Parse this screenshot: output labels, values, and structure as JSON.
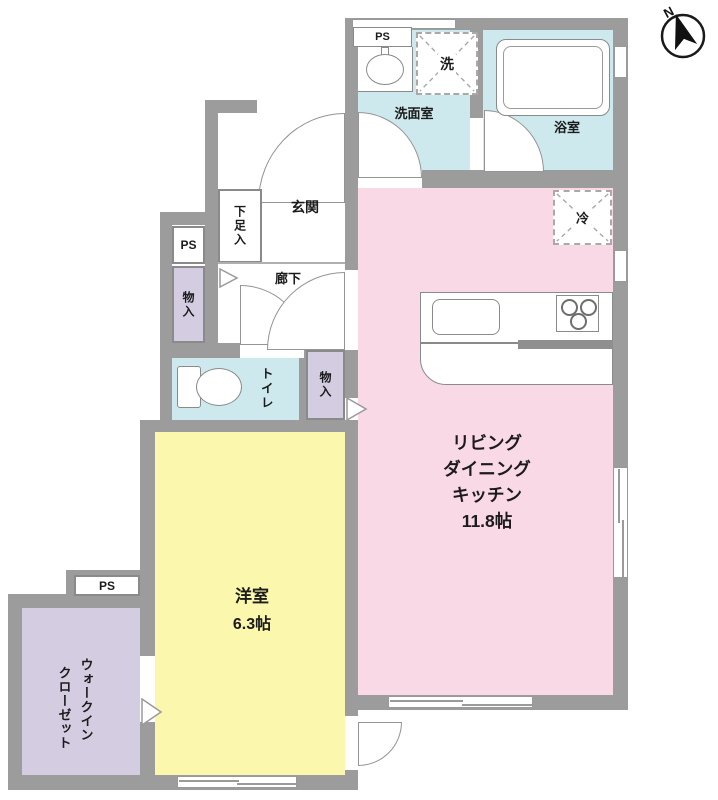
{
  "compass": {
    "north": "N"
  },
  "labels": {
    "ps": "PS"
  },
  "fixtures": {
    "washer": "洗",
    "fridge": "冷"
  },
  "rooms": {
    "ldk": {
      "lines": [
        "リビング",
        "ダイニング",
        "キッチン"
      ],
      "size": "11.8帖"
    },
    "bedroom": {
      "name": "洋室",
      "size": "6.3帖"
    },
    "washroom": {
      "name": "洗面室"
    },
    "bathroom": {
      "name": "浴室"
    },
    "toilet": {
      "name": "トイレ"
    },
    "hallway": {
      "name": "廊下"
    },
    "entrance": {
      "name": "玄関"
    },
    "shoe_cabinet": {
      "name": "下足入"
    },
    "storage_hall": {
      "name": "物入"
    },
    "storage_ldk": {
      "name": "物入"
    },
    "walk_in_closet": {
      "lines": [
        "ウォークイン",
        "クローゼット"
      ]
    }
  },
  "colors": {
    "wall": "#9c9c9c",
    "ldk_pink": "#f9d9e5",
    "bedroom_yellow": "#fbf8ad",
    "wet_cyan": "#cde9ed",
    "storage_lavender": "#d4cde2"
  }
}
